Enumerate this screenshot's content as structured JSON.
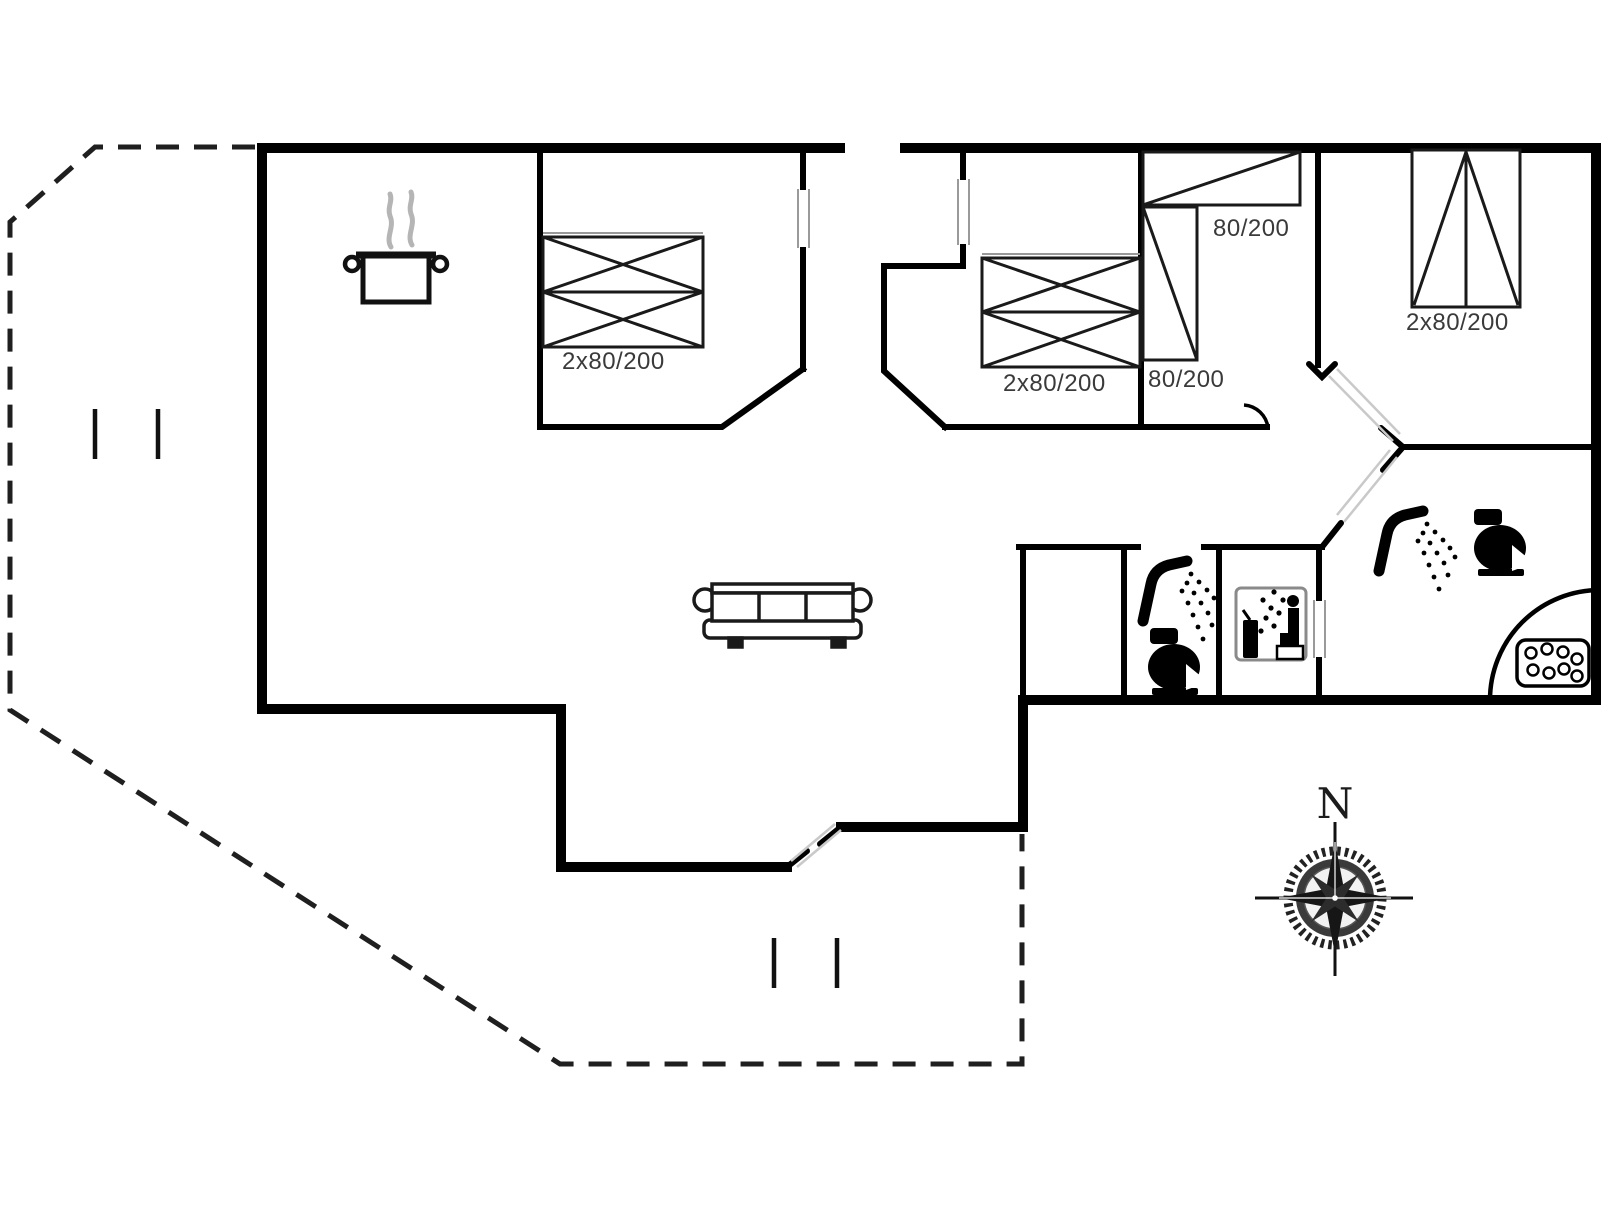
{
  "labels": {
    "bedroom1_bed": "2x80/200",
    "bedroom2_bed": "2x80/200",
    "bedroom3_bed_top": "80/200",
    "bedroom3_bed_side": "80/200",
    "bedroom4_bed": "2x80/200",
    "compass_north": "N"
  },
  "colors": {
    "wall": "#000000",
    "label_text": "#3a3a3a",
    "background": "#ffffff",
    "steam_gray": "#b5b5b5",
    "door_frame_gray": "#9a9a9a"
  },
  "icons": [
    "cooking-pot-icon",
    "sofa-icon",
    "shower-icon",
    "toilet-icon",
    "sauna-icon",
    "whirlpool-tub-icon",
    "compass-rose-icon"
  ]
}
